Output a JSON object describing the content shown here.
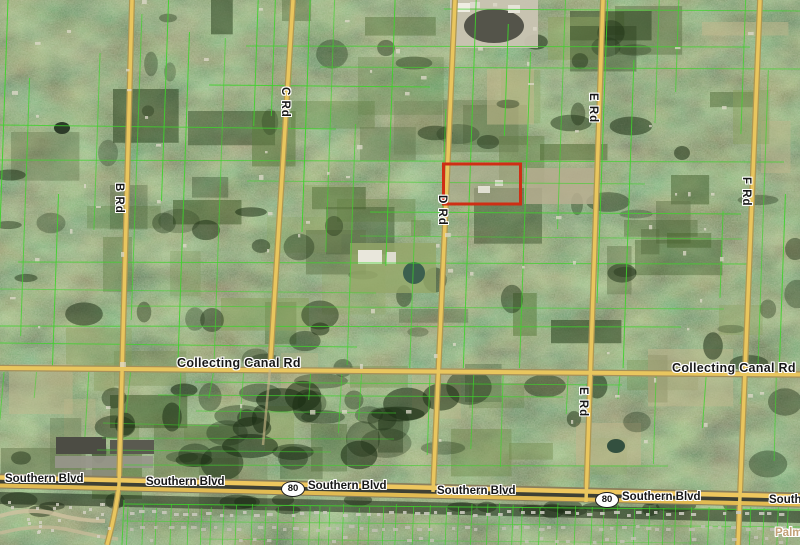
{
  "map": {
    "v_labels": [
      "B Rd",
      "C Rd",
      "D Rd",
      "E Rd",
      "E Rd",
      "F Rd"
    ],
    "canal_labels": [
      "Collecting Canal Rd",
      "Collecting Canal Rd"
    ],
    "southern_labels": [
      "Southern Blvd",
      "Southern Blvd",
      "Southern Blvd",
      "Southern Blvd",
      "Southern Blvd",
      "South"
    ],
    "shields": [
      "80",
      "80"
    ],
    "corner_label": "Palm",
    "colors": {
      "parcel_line": "#3ed32b",
      "road": "#e9c65e",
      "highlight_outline": "#cf2e14",
      "vegetation_base": "#3d5129"
    }
  }
}
